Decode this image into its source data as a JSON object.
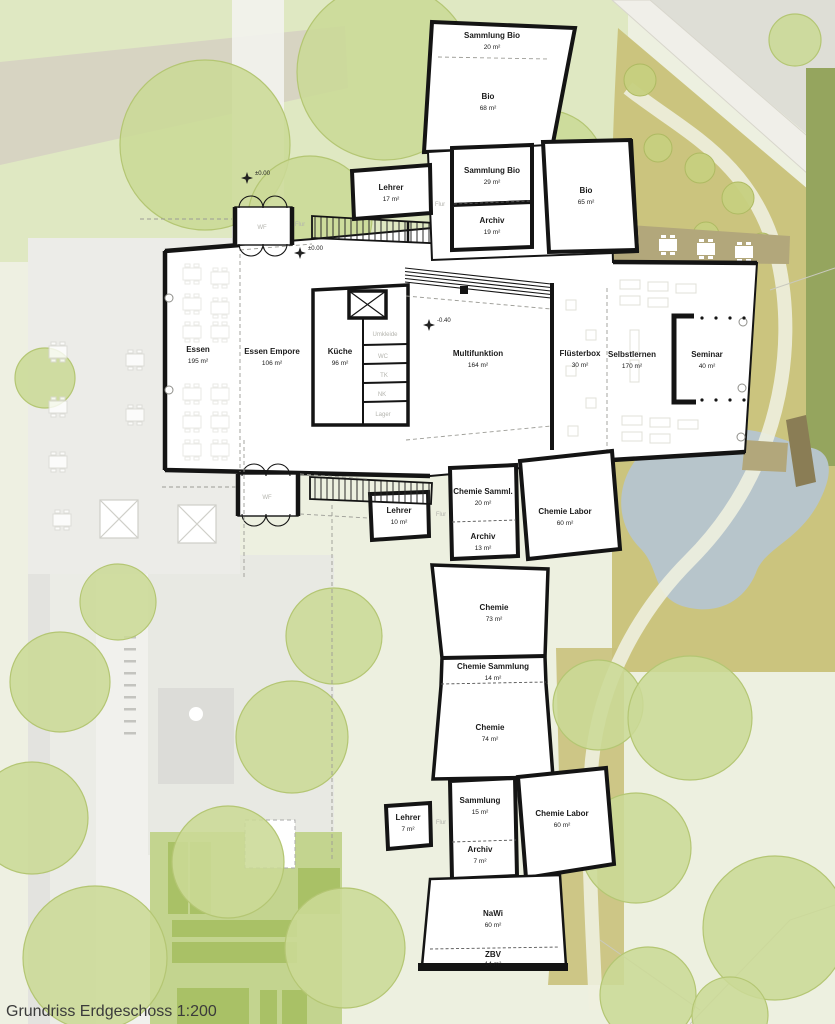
{
  "caption": "Grundriss Erdgeschoss 1:200",
  "rooms": [
    {
      "id": "sammlung-bio-1",
      "name": "Sammlung Bio",
      "area": "20 m²"
    },
    {
      "id": "bio-1",
      "name": "Bio",
      "area": "68 m²"
    },
    {
      "id": "lehrer-1",
      "name": "Lehrer",
      "area": "17 m²"
    },
    {
      "id": "sammlung-bio-2",
      "name": "Sammlung Bio",
      "area": "29 m²"
    },
    {
      "id": "archiv-1",
      "name": "Archiv",
      "area": "19 m²"
    },
    {
      "id": "bio-2",
      "name": "Bio",
      "area": "65 m²"
    },
    {
      "id": "essen",
      "name": "Essen",
      "area": "195 m²"
    },
    {
      "id": "essen-empore",
      "name": "Essen Empore",
      "area": "106 m²"
    },
    {
      "id": "kueche",
      "name": "Küche",
      "area": "96 m²"
    },
    {
      "id": "multifunktion",
      "name": "Multifunktion",
      "area": "164 m²"
    },
    {
      "id": "fluesterbox",
      "name": "Flüsterbox",
      "area": "30 m²"
    },
    {
      "id": "selbstlernen",
      "name": "Selbstlernen",
      "area": "170 m²"
    },
    {
      "id": "seminar",
      "name": "Seminar",
      "area": "40 m²"
    },
    {
      "id": "chemie-samml",
      "name": "Chemie Samml.",
      "area": "20 m²"
    },
    {
      "id": "lehrer-2",
      "name": "Lehrer",
      "area": "10 m²"
    },
    {
      "id": "archiv-2",
      "name": "Archiv",
      "area": "13 m²"
    },
    {
      "id": "chemie-labor-1",
      "name": "Chemie Labor",
      "area": "60 m²"
    },
    {
      "id": "chemie-1",
      "name": "Chemie",
      "area": "73 m²"
    },
    {
      "id": "chemie-sammlung",
      "name": "Chemie Sammlung",
      "area": "14 m²"
    },
    {
      "id": "chemie-2",
      "name": "Chemie",
      "area": "74 m²"
    },
    {
      "id": "sammlung",
      "name": "Sammlung",
      "area": "15 m²"
    },
    {
      "id": "lehrer-3",
      "name": "Lehrer",
      "area": "7 m²"
    },
    {
      "id": "archiv-3",
      "name": "Archiv",
      "area": "7 m²"
    },
    {
      "id": "chemie-labor-2",
      "name": "Chemie Labor",
      "area": "60 m²"
    },
    {
      "id": "nawi",
      "name": "NaWi",
      "area": "60 m²"
    },
    {
      "id": "zbv",
      "name": "ZBV",
      "area": "14 m²"
    }
  ],
  "service_labels": [
    "Umkleide",
    "WC",
    "TK",
    "NK",
    "Lager"
  ],
  "corridor_labels": {
    "wf1": "WF",
    "flur1": "Flur",
    "flur2": "Flur",
    "wf2": "WF",
    "flur3": "Flur",
    "flur4": "Flur"
  },
  "level_markers": [
    {
      "label": "±0.00"
    },
    {
      "label": "±0.00"
    },
    {
      "label": "-0.40"
    }
  ],
  "colors": {
    "building": "#ffffff",
    "wall": "#141414",
    "lawn": "#e0e9c6",
    "tree": "#cbd996",
    "olive": "#cbc47e",
    "pond": "#b7c5cb",
    "deck": "#b2a77b",
    "bridge": "#8a7d55",
    "road": "#f0efe9",
    "beige_band": "#d6d0c2",
    "plot_green": "#a9c166",
    "faint_label": "#b4b4ae"
  }
}
